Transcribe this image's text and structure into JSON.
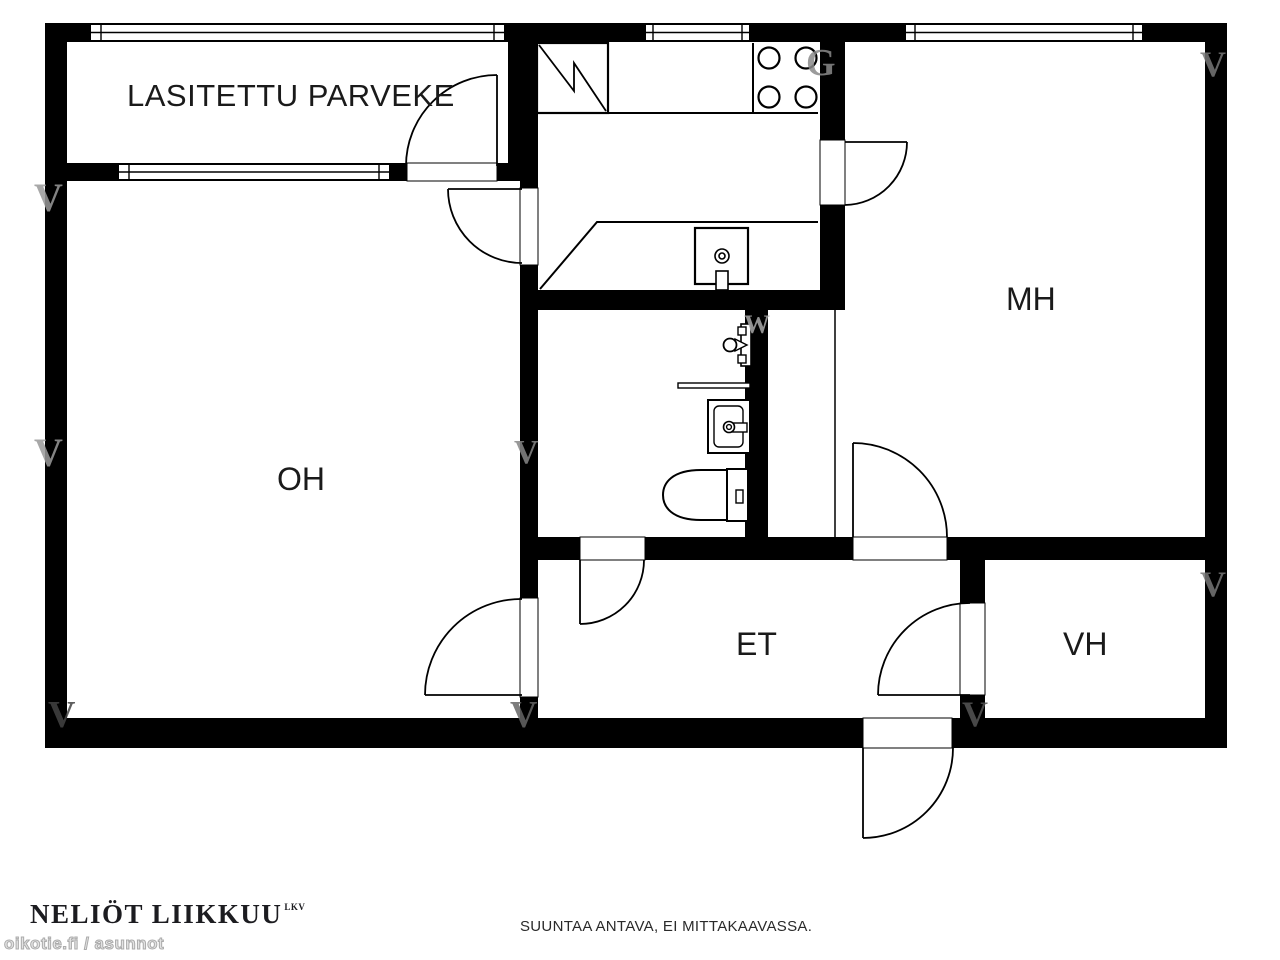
{
  "rooms": {
    "balcony": {
      "label": "LASITETTU PARVEKE"
    },
    "living_room": {
      "label": "OH"
    },
    "bedroom": {
      "label": "MH"
    },
    "entry_hall": {
      "label": "ET"
    },
    "closet": {
      "label": "VH"
    }
  },
  "fixtures": [
    "fridge",
    "stove-4-burners",
    "kitchen-counter",
    "kitchen-sink",
    "shower",
    "bathroom-shelf",
    "bathroom-sink",
    "toilet"
  ],
  "watermarks": [
    {
      "char": "V"
    },
    {
      "char": "V"
    },
    {
      "char": "V"
    },
    {
      "char": "V"
    },
    {
      "char": "G"
    },
    {
      "char": "V"
    },
    {
      "char": "V"
    },
    {
      "char": "V"
    },
    {
      "char": "V"
    },
    {
      "char": "W"
    }
  ],
  "footer": {
    "brand": "NELIÖT LIIKKUU",
    "brand_suffix": "LKV",
    "watermark_site": "oikotie.fi / asunnot",
    "disclaimer": "SUUNTAA ANTAVA, EI MITTAKAAVASSA."
  },
  "colors": {
    "wall": "#000000",
    "background": "#ffffff",
    "line": "#000000",
    "watermark_light": "#999999",
    "watermark_dark": "#555555"
  }
}
